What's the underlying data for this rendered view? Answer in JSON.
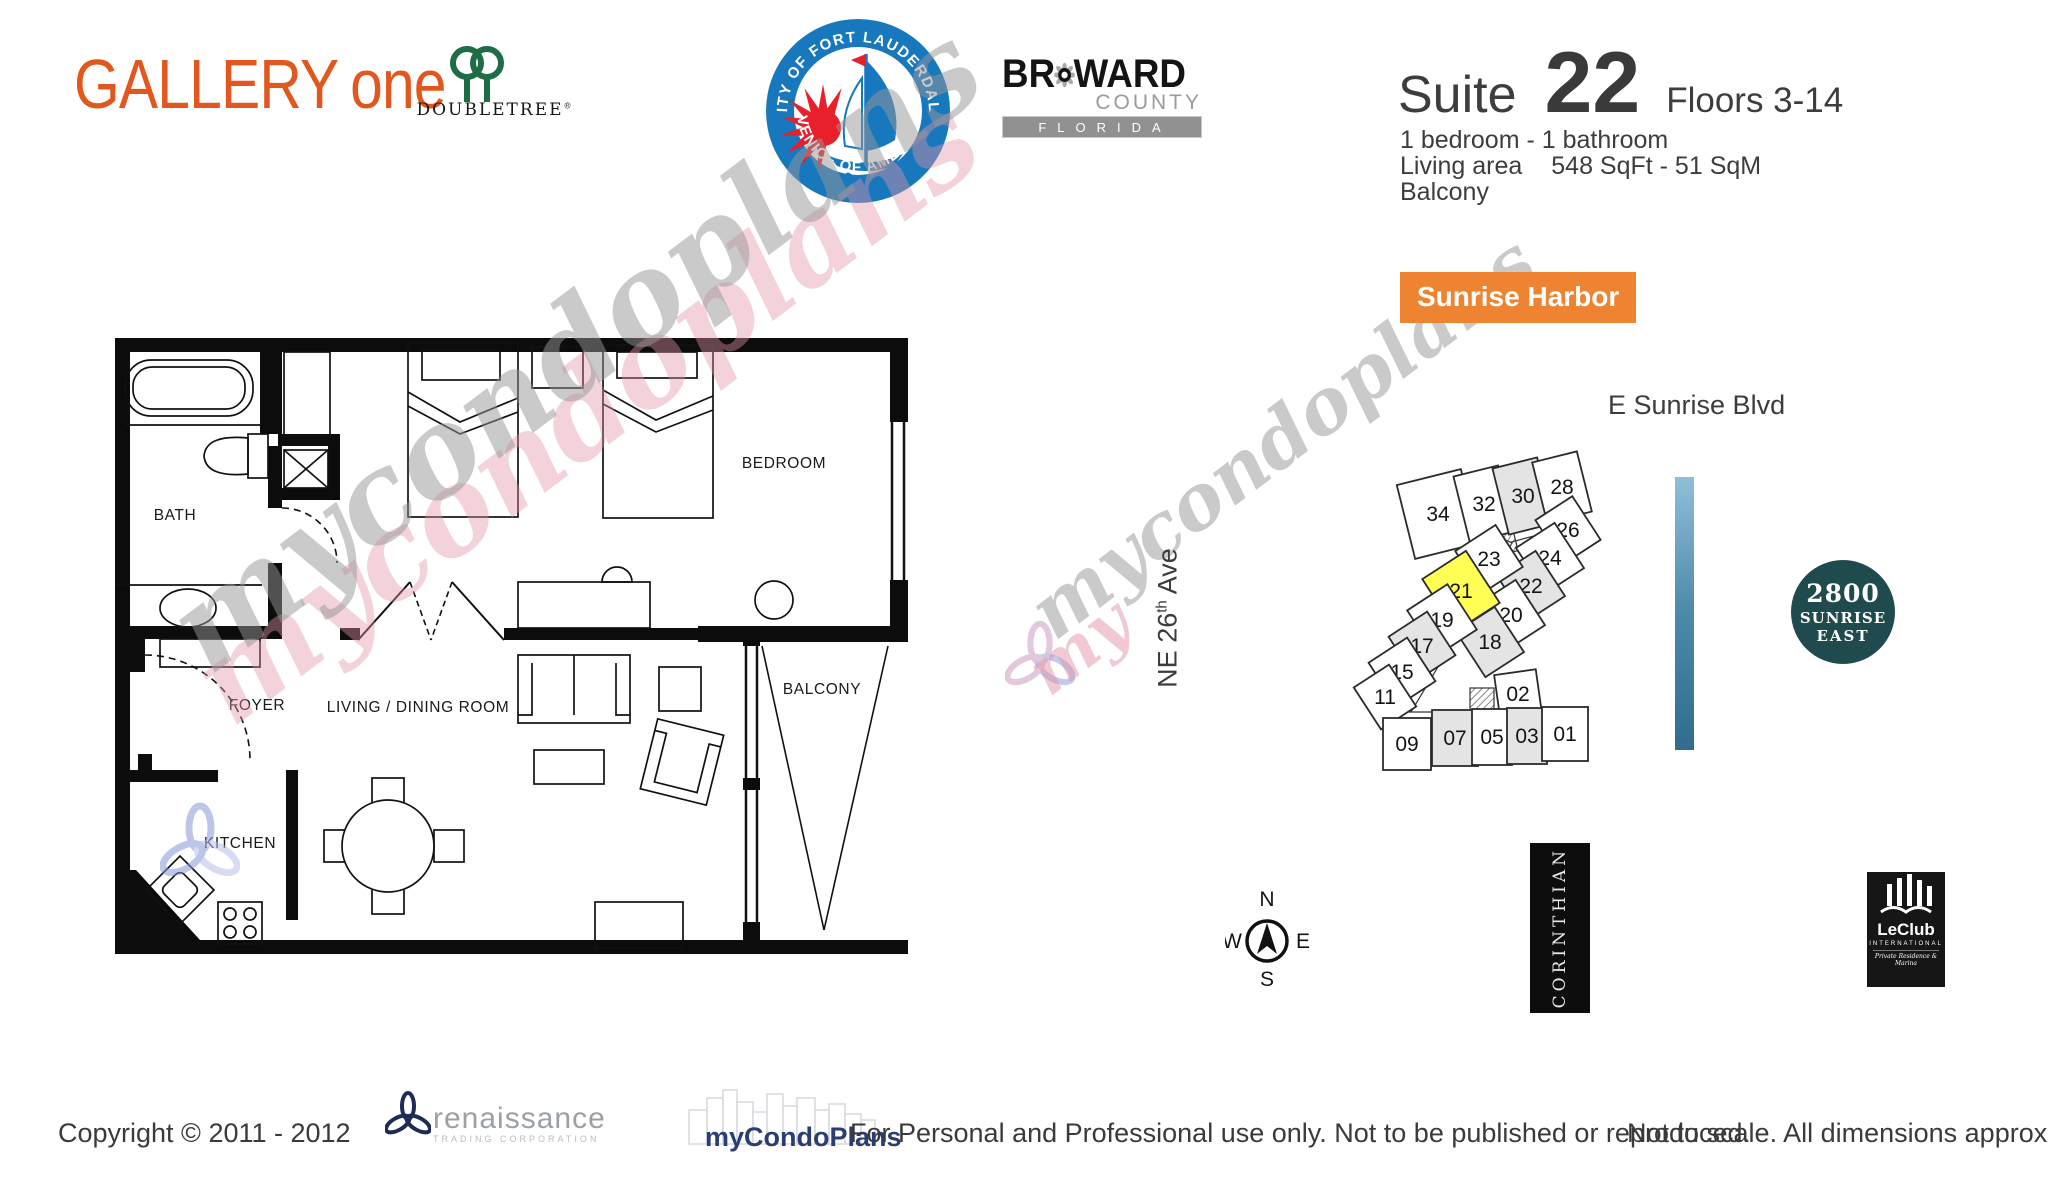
{
  "header": {
    "brand_gallery": "GALLERY",
    "brand_one": "one",
    "brand_color": "#e2571d",
    "doubletree_name": "DoubleTree",
    "doubletree_reg": "®",
    "seal_top": "CITY OF FORT LAUDERDALE",
    "seal_bottom": "VENICE OF AMERICA",
    "seal_blue": "#1878be",
    "seal_red": "#e8202c",
    "broward_br": "BR",
    "broward_ward": "WARD",
    "broward_county": "COUNTY",
    "broward_florida": "FLORIDA"
  },
  "suite": {
    "label": "Suite",
    "number": "22",
    "floors": "Floors 3-14",
    "bed_bath": "1 bedroom - 1 bathroom",
    "living_area_label": "Living area",
    "living_area_value": "548 SqFt - 51 SqM",
    "balcony": "Balcony"
  },
  "site_map": {
    "badge": "Sunrise Harbor",
    "badge_color": "#ee8432",
    "street_top": "E Sunrise Blvd",
    "street_left_prefix": "NE 26",
    "street_left_sup": "th",
    "street_left_suffix": " Ave",
    "highlight_color": "#ffff55",
    "shaded_color": "#e4e4e4",
    "units": [
      {
        "label": "34",
        "x": 108,
        "y": 84,
        "w": 66,
        "h": 76,
        "angle": -14,
        "fill": "w"
      },
      {
        "label": "32",
        "x": 154,
        "y": 74,
        "w": 46,
        "h": 68,
        "angle": -14,
        "fill": "w"
      },
      {
        "label": "30",
        "x": 193,
        "y": 66,
        "w": 46,
        "h": 68,
        "angle": -14,
        "fill": "g"
      },
      {
        "label": "28",
        "x": 232,
        "y": 57,
        "w": 46,
        "h": 62,
        "angle": -14,
        "fill": "w"
      },
      {
        "label": "26",
        "x": 238,
        "y": 100,
        "w": 44,
        "h": 52,
        "angle": -33,
        "fill": "w"
      },
      {
        "label": "24",
        "x": 220,
        "y": 128,
        "w": 46,
        "h": 54,
        "angle": -33,
        "fill": "w"
      },
      {
        "label": "22",
        "x": 201,
        "y": 156,
        "w": 46,
        "h": 54,
        "angle": -33,
        "fill": "g"
      },
      {
        "label": "20",
        "x": 181,
        "y": 185,
        "w": 46,
        "h": 54,
        "angle": -33,
        "fill": "w"
      },
      {
        "label": "18",
        "x": 160,
        "y": 212,
        "w": 46,
        "h": 54,
        "angle": -33,
        "fill": "g"
      },
      {
        "label": "02",
        "x": 188,
        "y": 264,
        "w": 42,
        "h": 44,
        "angle": -8,
        "fill": "w"
      },
      {
        "label": "23",
        "x": 159,
        "y": 129,
        "w": 48,
        "h": 50,
        "angle": -33,
        "fill": "w"
      },
      {
        "label": "21",
        "x": 131,
        "y": 161,
        "w": 52,
        "h": 62,
        "angle": -33,
        "fill": "y"
      },
      {
        "label": "19",
        "x": 112,
        "y": 190,
        "w": 48,
        "h": 54,
        "angle": -33,
        "fill": "w"
      },
      {
        "label": "17",
        "x": 92,
        "y": 216,
        "w": 46,
        "h": 52,
        "angle": -33,
        "fill": "g"
      },
      {
        "label": "15",
        "x": 72,
        "y": 242,
        "w": 46,
        "h": 52,
        "angle": -33,
        "fill": "w"
      },
      {
        "label": "11",
        "x": 55,
        "y": 267,
        "w": 42,
        "h": 50,
        "angle": -33,
        "fill": "w"
      },
      {
        "label": "09",
        "x": 77,
        "y": 314,
        "w": 48,
        "h": 52,
        "angle": 0,
        "fill": "w"
      },
      {
        "label": "07",
        "x": 125,
        "y": 308,
        "w": 46,
        "h": 56,
        "angle": 0,
        "fill": "g"
      },
      {
        "label": "05",
        "x": 162,
        "y": 307,
        "w": 40,
        "h": 56,
        "angle": 0,
        "fill": "w"
      },
      {
        "label": "03",
        "x": 197,
        "y": 306,
        "w": 40,
        "h": 56,
        "angle": 0,
        "fill": "g"
      },
      {
        "label": "01",
        "x": 235,
        "y": 304,
        "w": 46,
        "h": 54,
        "angle": 0,
        "fill": "w"
      }
    ]
  },
  "floor_plan": {
    "rooms": {
      "bath": "BATH",
      "bedroom": "BEDROOM",
      "foyer": "FOYER",
      "living": "LIVING / DINING ROOM",
      "kitchen": "KITCHEN",
      "balcony": "BALCONY"
    }
  },
  "landmarks": {
    "sunrise2800_line1": "2800",
    "sunrise2800_line2": "SUNRISE",
    "sunrise2800_line3": "EAST",
    "corinthian": "CORINTHIAN",
    "leclub_name": "LeClub",
    "leclub_sub": "INTERNATIONAL",
    "leclub_tag": "Private Residence & Marina",
    "compass_n": "N",
    "compass_e": "E",
    "compass_s": "S",
    "compass_w": "W"
  },
  "watermark": {
    "text": "mycondoplans",
    "text_short": "my"
  },
  "footer": {
    "copyright": "Copyright © 2011 - 2012",
    "renaissance_name": "renaissance",
    "renaissance_sub": "TRADING CORPORATION",
    "mycondoplans": "myCondoPlans",
    "usage": "For Personal and Professional use only.  Not to be published or reproduced.",
    "scale_note": "Not to scale.  All dimensions approximate."
  }
}
